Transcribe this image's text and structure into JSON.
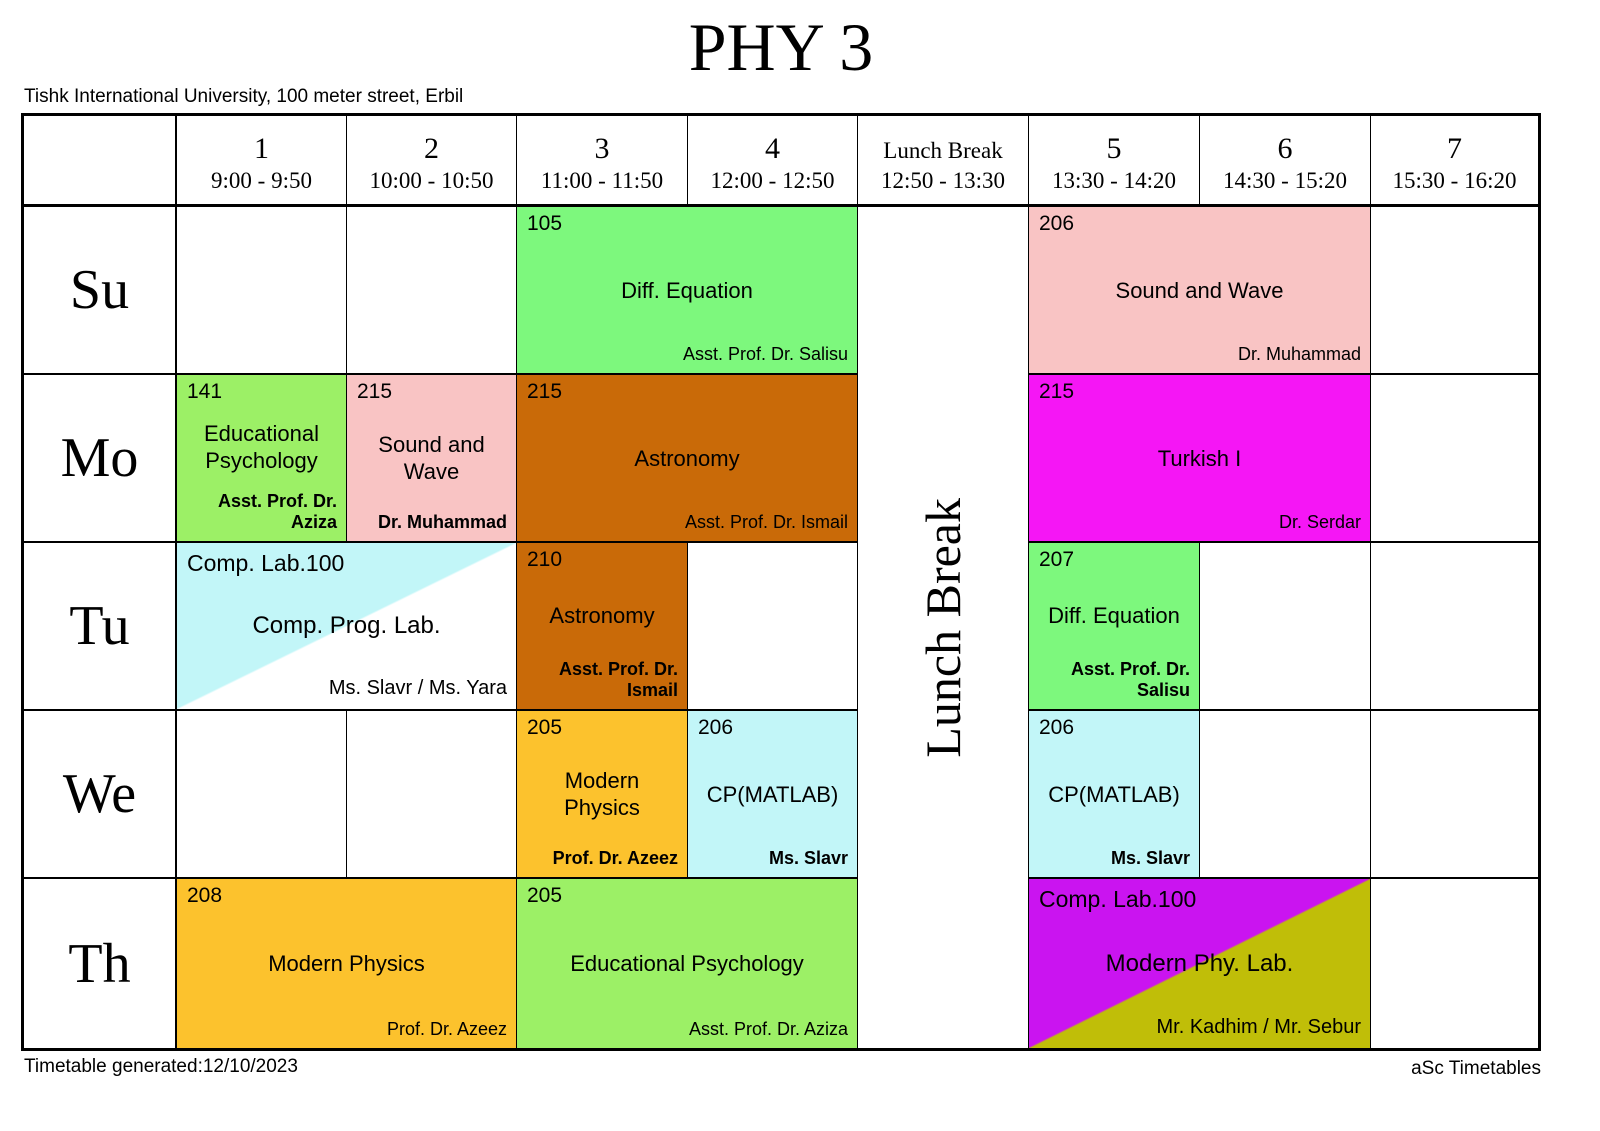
{
  "title": "PHY 3",
  "subtitle": "Tishk International University, 100 meter street, Erbil",
  "lunch_label": "Lunch Break",
  "footer": {
    "left": "Timetable generated:12/10/2023",
    "right": "aSc Timetables"
  },
  "colors": {
    "green": "#7df87d",
    "green2": "#9cf066",
    "pink": "#f9c4c4",
    "brown": "#c96a08",
    "magenta": "#f516f5",
    "cyan": "#c2f6f8",
    "orange": "#fcc22d",
    "purple": "#ca14f0",
    "olive": "#c0be08",
    "white": "#ffffff"
  },
  "days": [
    "Su",
    "Mo",
    "Tu",
    "We",
    "Th"
  ],
  "header": {
    "periods": [
      {
        "num": "1",
        "time": "9:00 - 9:50"
      },
      {
        "num": "2",
        "time": "10:00 - 10:50"
      },
      {
        "num": "3",
        "time": "11:00 - 11:50"
      },
      {
        "num": "4",
        "time": "12:00 - 12:50"
      },
      {
        "num": "Lunch Break",
        "time": "12:50 - 13:30",
        "lunch": true
      },
      {
        "num": "5",
        "time": "13:30 - 14:20"
      },
      {
        "num": "6",
        "time": "14:30 - 15:20"
      },
      {
        "num": "7",
        "time": "15:30 - 16:20"
      }
    ]
  },
  "cells": [
    {
      "day": "Su",
      "col": 3,
      "span": 2,
      "color": "green",
      "room": "105",
      "course": "Diff.  Equation",
      "teacher": "Asst. Prof. Dr. Salisu",
      "teacher_bold": false
    },
    {
      "day": "Su",
      "col": 5,
      "span": 2,
      "color": "pink",
      "room": "206",
      "course": "Sound and Wave",
      "teacher": "Dr. Muhammad",
      "teacher_bold": false
    },
    {
      "day": "Mo",
      "col": 1,
      "span": 1,
      "color": "green2",
      "room": "141",
      "course": "Educational Psychology",
      "teacher": "Asst. Prof. Dr. Aziza",
      "teacher_bold": true
    },
    {
      "day": "Mo",
      "col": 2,
      "span": 1,
      "color": "pink",
      "room": "215",
      "course": "Sound and Wave",
      "teacher": "Dr. Muhammad",
      "teacher_bold": true
    },
    {
      "day": "Mo",
      "col": 3,
      "span": 2,
      "color": "brown",
      "room": "215",
      "course": "Astronomy",
      "teacher": "Asst. Prof. Dr. Ismail",
      "teacher_bold": false
    },
    {
      "day": "Mo",
      "col": 5,
      "span": 2,
      "color": "magenta",
      "room": "215",
      "course": "Turkish I",
      "teacher": "Dr. Serdar",
      "teacher_bold": false
    },
    {
      "day": "Tu",
      "col": 1,
      "span": 2,
      "type": "diagonal",
      "color_tl": "cyan",
      "color_br": "white",
      "room": "Comp. Lab.100",
      "course": "Comp. Prog. Lab.",
      "teacher": "Ms. Slavr / Ms. Yara",
      "teacher_bold": false
    },
    {
      "day": "Tu",
      "col": 3,
      "span": 1,
      "color": "brown",
      "room": "210",
      "course": "Astronomy",
      "teacher": "Asst. Prof. Dr. Ismail",
      "teacher_bold": true
    },
    {
      "day": "Tu",
      "col": 5,
      "span": 1,
      "color": "green",
      "room": "207",
      "course": "Diff.  Equation",
      "teacher": "Asst. Prof. Dr. Salisu",
      "teacher_bold": true
    },
    {
      "day": "We",
      "col": 3,
      "span": 1,
      "color": "orange",
      "room": "205",
      "course": "Modern Physics",
      "teacher": "Prof. Dr. Azeez",
      "teacher_bold": true
    },
    {
      "day": "We",
      "col": 4,
      "span": 1,
      "color": "cyan",
      "room": "206",
      "course": "CP(MATLAB)",
      "teacher": "Ms. Slavr",
      "teacher_bold": true
    },
    {
      "day": "We",
      "col": 5,
      "span": 1,
      "color": "cyan",
      "room": "206",
      "course": "CP(MATLAB)",
      "teacher": "Ms. Slavr",
      "teacher_bold": true
    },
    {
      "day": "Th",
      "col": 1,
      "span": 2,
      "color": "orange",
      "room": "208",
      "course": "Modern Physics",
      "teacher": "Prof. Dr. Azeez",
      "teacher_bold": false
    },
    {
      "day": "Th",
      "col": 3,
      "span": 2,
      "color": "green2",
      "room": "205",
      "course": "Educational Psychology",
      "teacher": "Asst. Prof. Dr. Aziza",
      "teacher_bold": false
    },
    {
      "day": "Th",
      "col": 5,
      "span": 2,
      "type": "diagonal",
      "color_tl": "purple",
      "color_br": "olive",
      "room": "Comp. Lab.100",
      "course": "Modern Phy. Lab.",
      "teacher": "Mr. Kadhim / Mr. Sebur",
      "teacher_bold": false
    }
  ]
}
